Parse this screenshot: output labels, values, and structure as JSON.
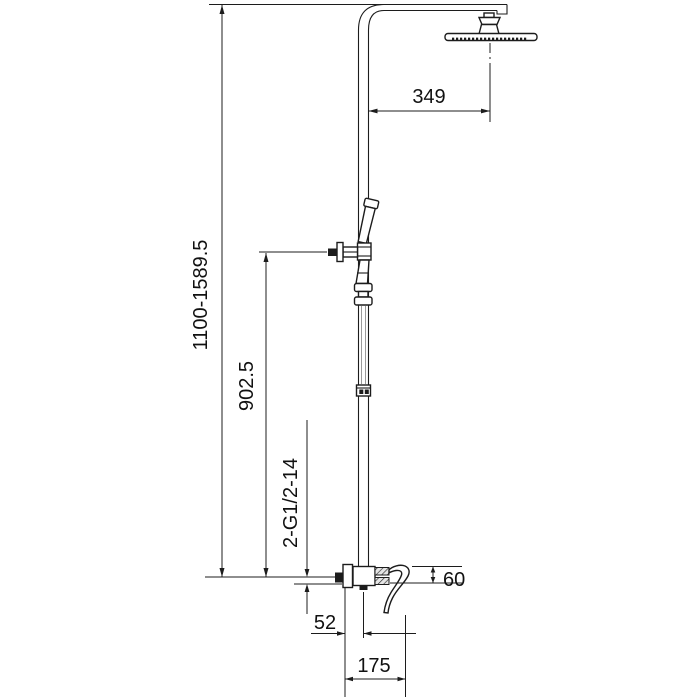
{
  "drawing": {
    "colors": {
      "background": "#ffffff",
      "line": "#1c1c1c",
      "text": "#111111"
    },
    "dimensions": {
      "overall_height": "1100-1589.5",
      "head_reach": "349",
      "hand_shower_height": "902.5",
      "thread_spec": "2-G1/2-14",
      "spout_drop": "60",
      "center_offset": "52",
      "base_width": "175"
    }
  }
}
